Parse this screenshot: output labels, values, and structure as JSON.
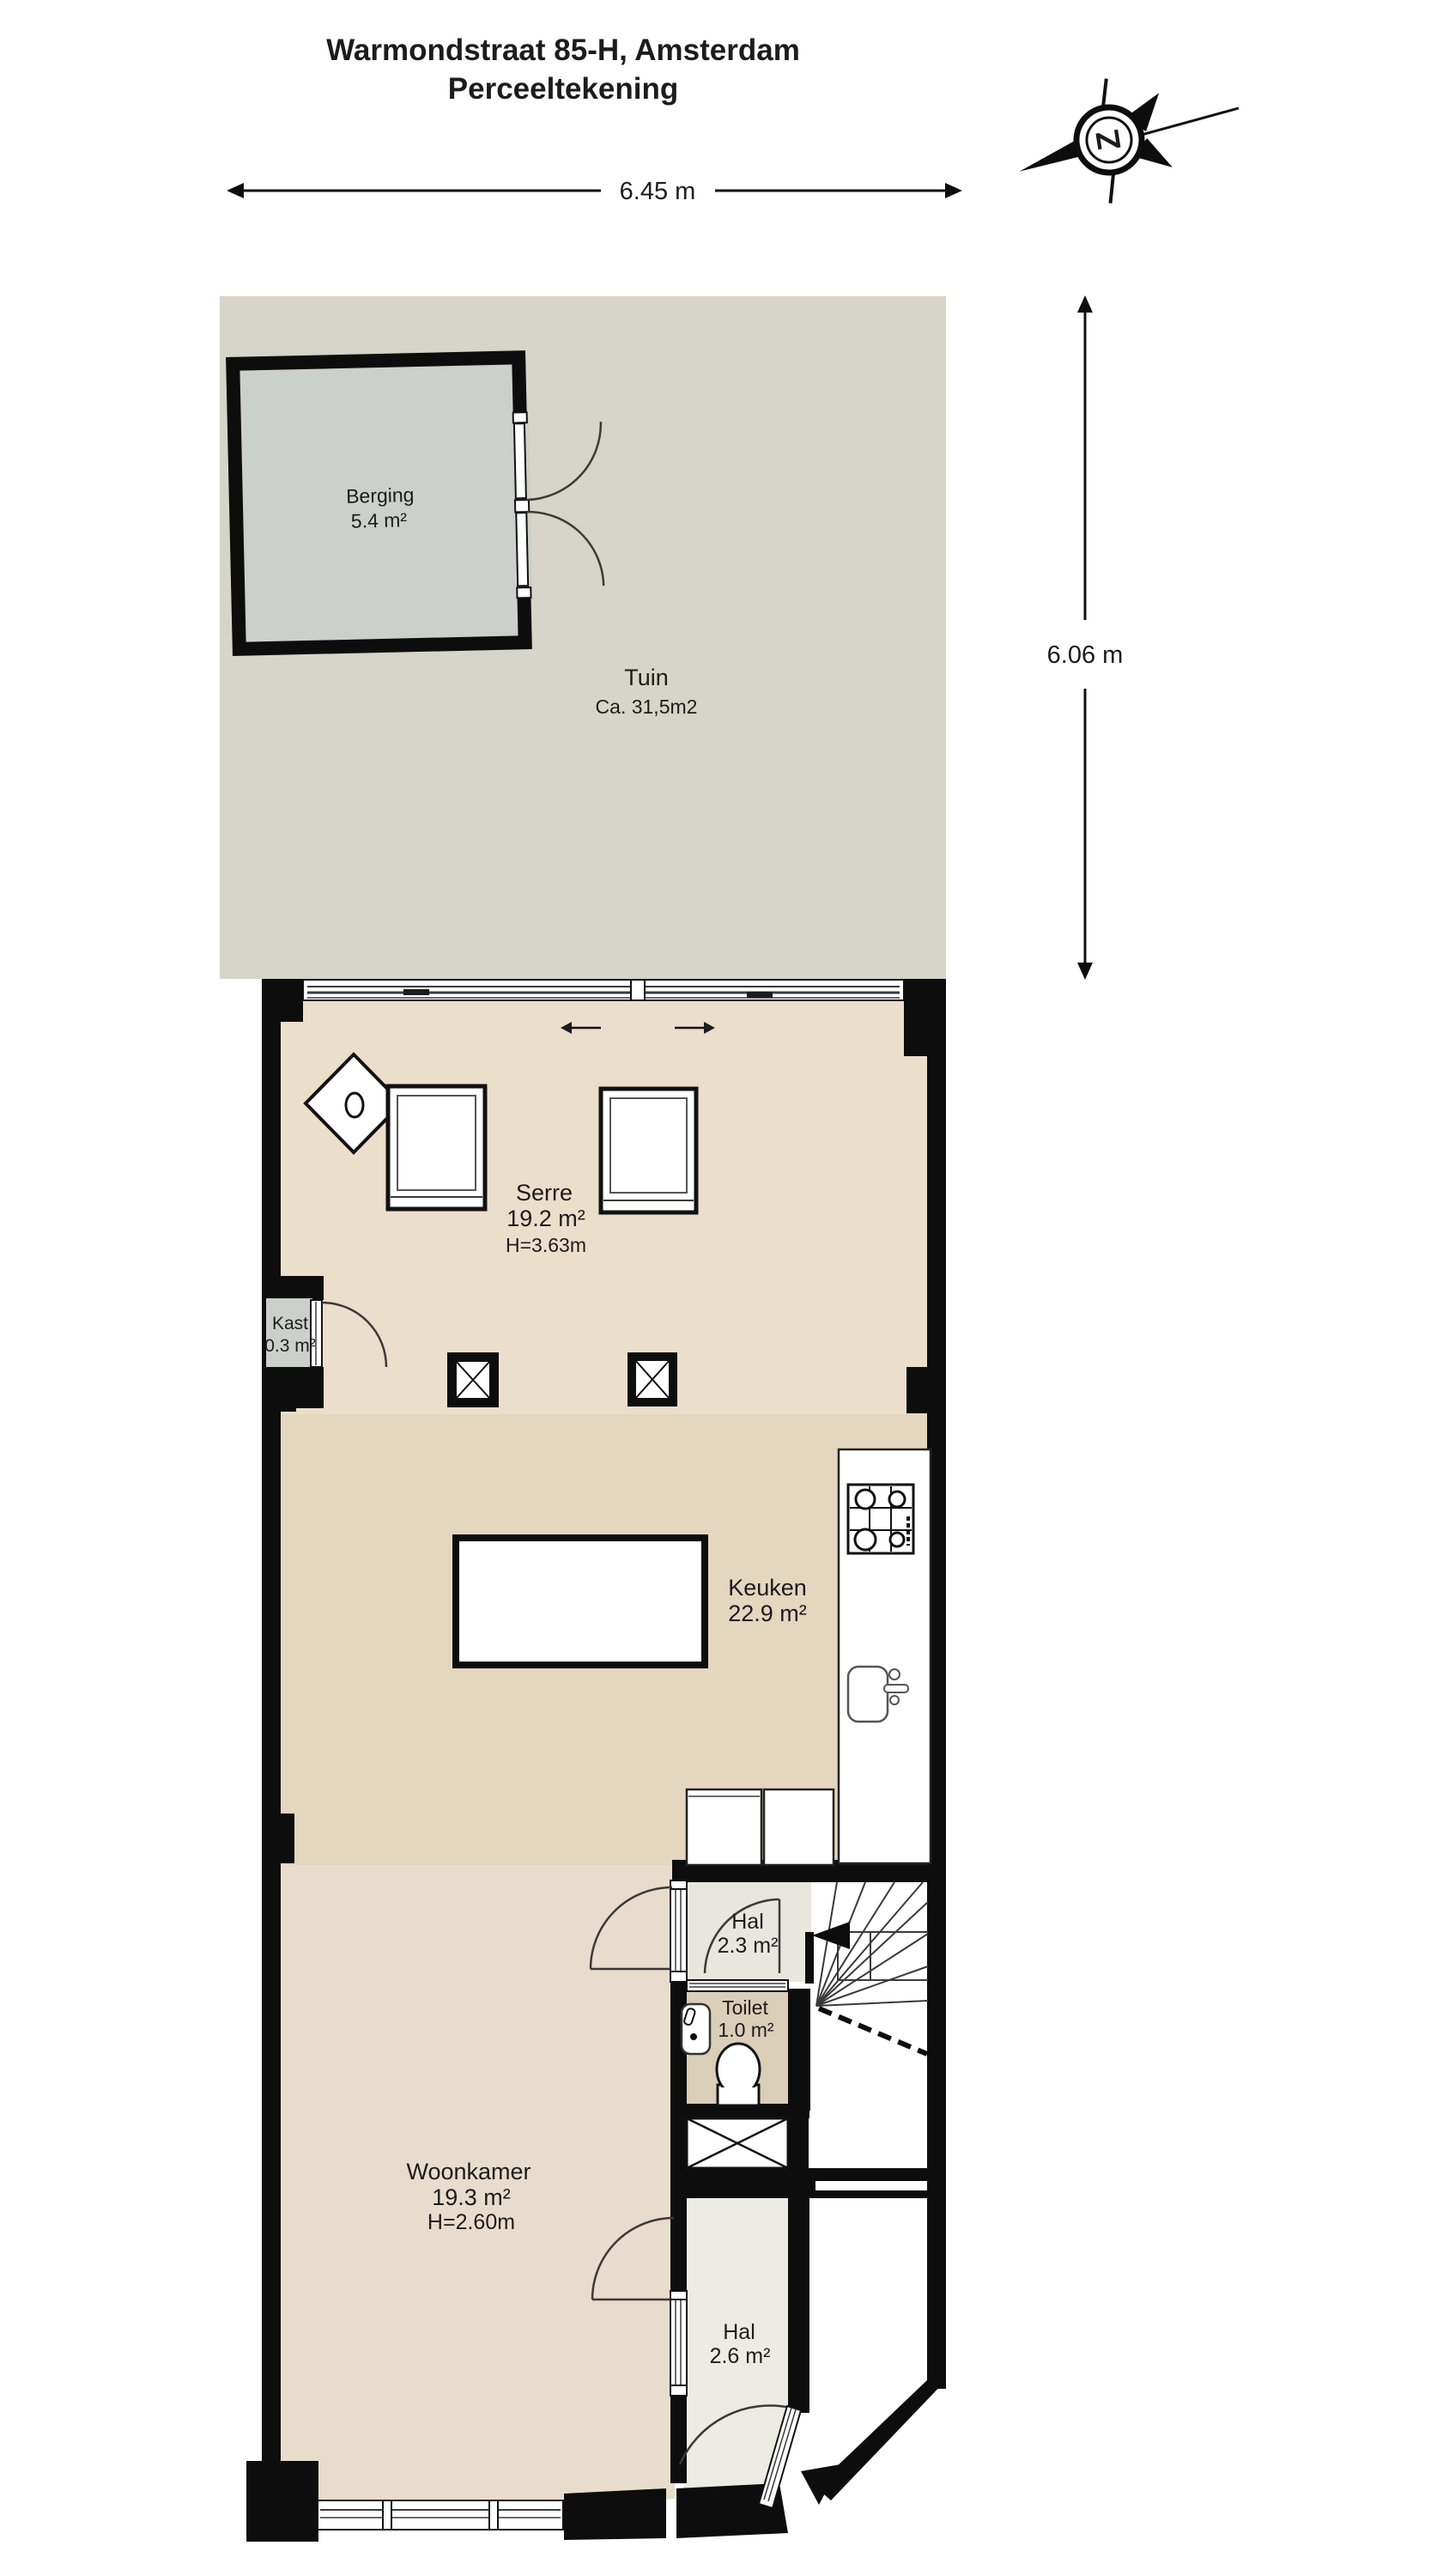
{
  "title": {
    "line1": "Warmondstraat 85-H, Amsterdam",
    "line2": "Perceeltekening"
  },
  "dimensions": {
    "plot_width": "6.45 m",
    "plot_depth": "6.06 m"
  },
  "compass": {
    "letter": "Z"
  },
  "rooms": {
    "tuin": {
      "name": "Tuin",
      "area": "Ca. 31,5m2"
    },
    "berging": {
      "name": "Berging",
      "area": "5.4 m²"
    },
    "serre": {
      "name": "Serre",
      "area": "19.2 m²",
      "height": "H=3.63m"
    },
    "kast": {
      "name": "Kast",
      "area": "0.3 m²"
    },
    "keuken": {
      "name": "Keuken",
      "area": "22.9 m²"
    },
    "hal_boven": {
      "name": "Hal",
      "area": "2.3 m²"
    },
    "toilet": {
      "name": "Toilet",
      "area": "1.0 m²"
    },
    "woonkamer": {
      "name": "Woonkamer",
      "area": "19.3 m²",
      "height": "H=2.60m"
    },
    "hal_entree": {
      "name": "Hal",
      "area": "2.6 m²"
    }
  },
  "colors": {
    "wall": "#0d0d0d",
    "tuin": "#d7d4c9",
    "berging": "#ccd0ca",
    "serre_floor": "#ebdecb",
    "keuken_floor": "#e4d6bf",
    "woonkamer_floor": "#e8ddcc",
    "hal_floor": "#e9e6df",
    "toilet_floor": "#dbceb8",
    "entree_floor": "#ecebe4",
    "fixture": "#ffffff",
    "text": "#1c1c1c"
  }
}
